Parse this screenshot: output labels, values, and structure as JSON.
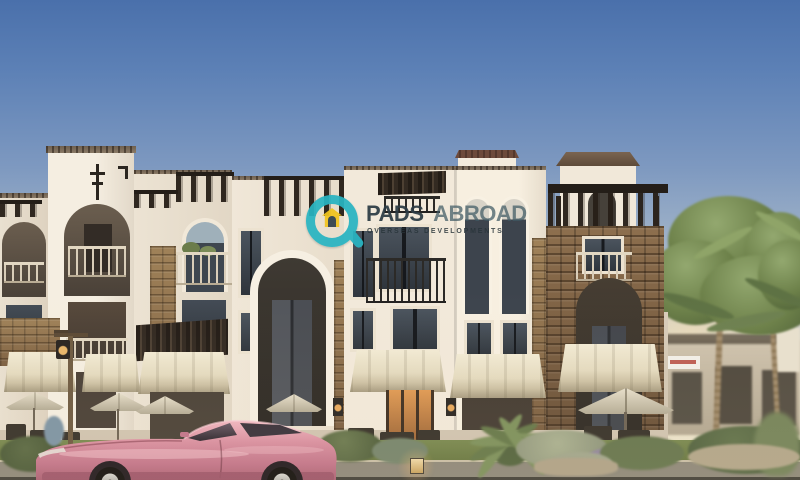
{
  "watermark": {
    "title_primary": "PADS",
    "title_secondary": "ABROAD",
    "subtitle": "OVERSEAS DEVELOPMENTS",
    "icon": "magnifier-house-logo",
    "colors": {
      "ring_teal": "#28b4c2",
      "house_yellow": "#f2c41d",
      "title": "#2c3b44",
      "title_secondary": "#3f5a64",
      "subtitle": "#2e3a40"
    }
  },
  "scene": {
    "subject": "Mediterranean-style townhouse complex rendering with rooftop pergolas, stone towers, awnings, palm trees, landscaped street and a pink sports car",
    "colors": {
      "sky_top": "#4a70ab",
      "sky_horizon": "#ede4cb",
      "stucco": "#f2e9da",
      "stone": "#8a6c4c",
      "pergola_wood": "#2f2822",
      "awning_cream": "#efe7cf",
      "car_pink": "#d4879a",
      "foliage": "#5f7348",
      "road": "#8f897a"
    }
  }
}
